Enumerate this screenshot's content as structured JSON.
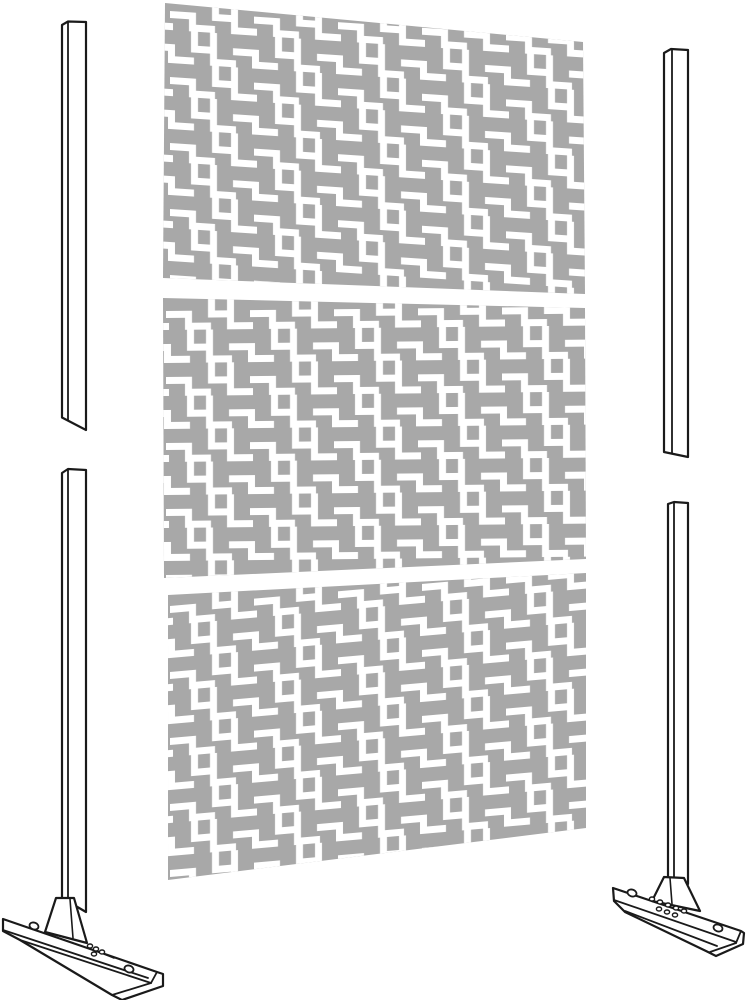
{
  "scene": {
    "title": "Decorative privacy screen kit - exploded parts illustration",
    "visible_text": "",
    "part_count": 7
  },
  "colors": {
    "background": "#ffffff",
    "panel": "#a8a8a8",
    "pattern": "#ffffff",
    "line": "#1a1a1a"
  },
  "pattern": {
    "tile_width": "84",
    "tile_height": "66",
    "motif": "staircase-squares lattice cutout"
  },
  "panels": {
    "top": {
      "points": "165,3 583,42 585,294 163,278",
      "pattern_transform": "translate(170,6) skewY(3.8)"
    },
    "middle": {
      "points": "163,298 585,308 586,559 164,578",
      "pattern_transform": "translate(166,306) skewY(-0.6)"
    },
    "bottom": {
      "points": "168,595 586,573 586,828 168,880",
      "pattern_transform": "translate(170,601) skewY(-5)"
    }
  },
  "parts": [
    {
      "name": "screen-panel-top",
      "kind": "decorative laser-cut panel"
    },
    {
      "name": "screen-panel-middle",
      "kind": "decorative laser-cut panel"
    },
    {
      "name": "screen-panel-bottom",
      "kind": "decorative laser-cut panel"
    },
    {
      "name": "post-top-left",
      "kind": "support post"
    },
    {
      "name": "post-top-right",
      "kind": "support post"
    },
    {
      "name": "post-bottom-left",
      "kind": "support post with base stand"
    },
    {
      "name": "post-bottom-right",
      "kind": "support post with base stand"
    }
  ]
}
